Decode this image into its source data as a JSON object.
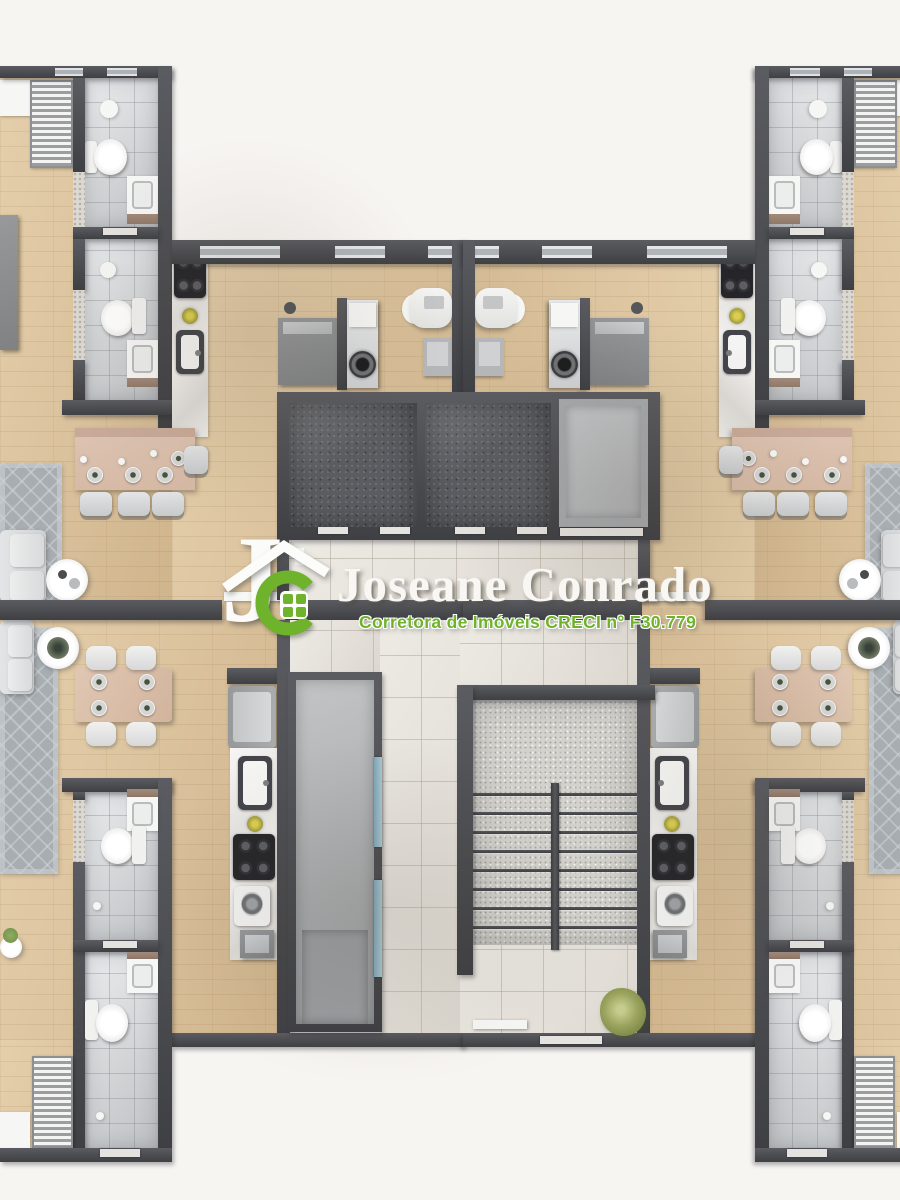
{
  "watermark": {
    "monogram_j": "J",
    "title": "Joseane Conrado",
    "subtitle": "Corretora de Imóveis  CRECI n° F30.779",
    "colors": {
      "brand_green": "#6fb32c",
      "title_white": "#f8f7f4"
    }
  },
  "floor_plan": {
    "kind": "apartment-building-typical-floor-plan-top-view-3d-render",
    "visible_units": 4,
    "core_rooms": [
      "elevator-shaft-left",
      "elevator-shaft-right",
      "elevator-cab",
      "utility-shaft",
      "stair-hall",
      "staircase",
      "corridor"
    ],
    "unit_rooms": [
      "bathroom-1",
      "bathroom-2",
      "kitchen",
      "breakfast-bar",
      "living-room",
      "dining-room",
      "laundry"
    ],
    "fixtures": [
      "toilet",
      "vanity-sink",
      "round-sink",
      "shower",
      "stove",
      "kitchen-sink",
      "fridge",
      "washer",
      "breakfast-bar-stools",
      "dining-table",
      "sofa",
      "rug",
      "coffee-table",
      "wardrobe",
      "desk",
      "plant"
    ],
    "palette": {
      "background": "#f7f5f2",
      "wall": "#4a4b4f",
      "wood_floor": "#dcc49f",
      "bathroom_tile": "#d2d4d6",
      "hall_tile": "#e6e2db",
      "stair_granite": "#d3d2cd",
      "shaft_dark": "#5a5c61",
      "rug": "#a7adb1",
      "dining_wood": "#d9bfab",
      "glass_accent": "#8fb3c2",
      "plant_green": "#9aa45e"
    }
  }
}
